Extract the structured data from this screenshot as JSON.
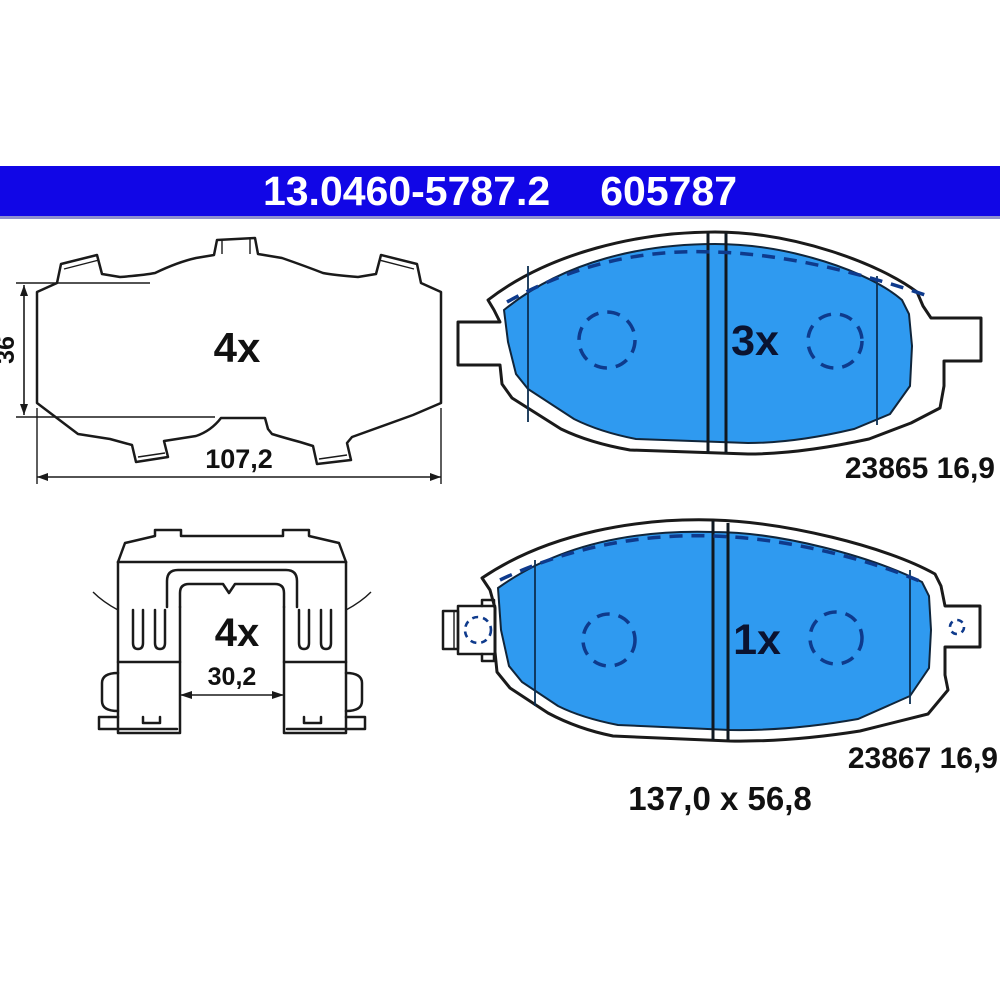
{
  "banner": {
    "part_number": "13.0460-5787.2",
    "reference_number": "605787",
    "background_color": "#1106E6",
    "text_color": "#ffffff"
  },
  "colors": {
    "pad_blue": "#2F9AF0",
    "dash_navy": "#0E3A8C",
    "quantity_navy": "#0A1330",
    "outline_black": "#1a1a1a"
  },
  "drawings": {
    "backplate": {
      "quantity": "4x",
      "height_dim": "36",
      "width_dim": "107,2"
    },
    "pad_upper": {
      "quantity": "3x",
      "label": "23865 16,9"
    },
    "clip": {
      "quantity": "4x",
      "width_dim": "30,2"
    },
    "pad_lower": {
      "quantity": "1x",
      "label": "23867 16,9"
    },
    "overall": {
      "dimensions": "137,0 x 56,8"
    }
  }
}
